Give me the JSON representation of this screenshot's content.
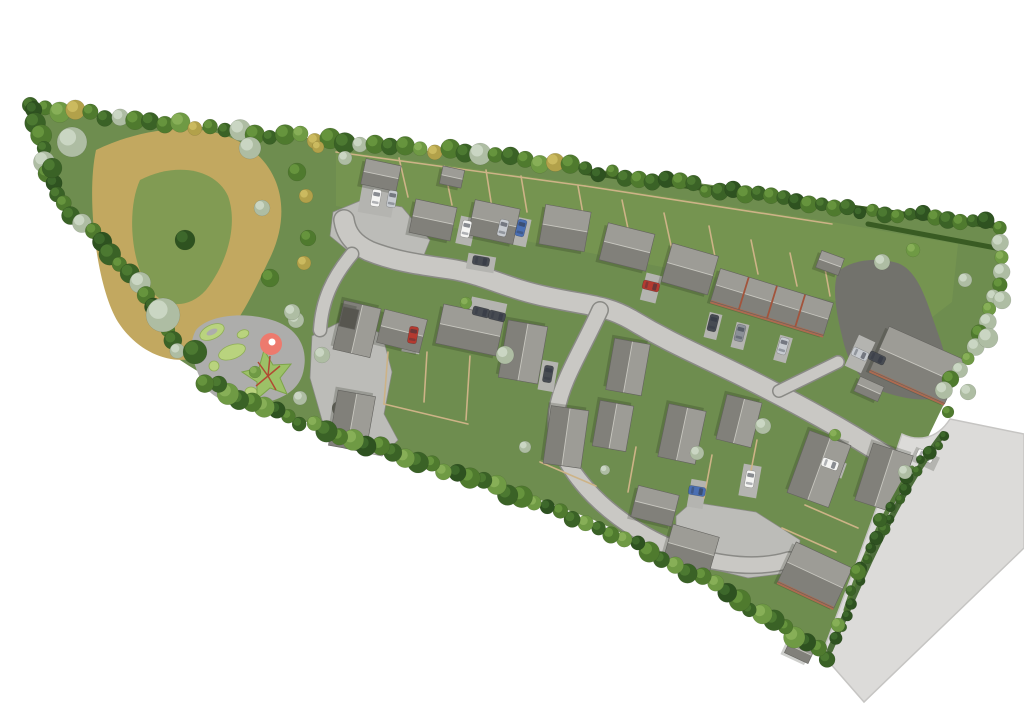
{
  "meta": {
    "description": "Aerial 3D rendered masterplan of a housing development with public open space, wildflower meadow, play area, tree-lined boundaries and an adjoining existing road",
    "canvas": {
      "w": 1024,
      "h": 723
    },
    "background": "#ffffff"
  },
  "palette": {
    "grass": "#6e8d4f",
    "garden_overlay": "#7c9c51",
    "meadow_tan": "#c2a860",
    "meadow_green": "#7d9a52",
    "paving": "#bcbcb8",
    "road_fill": "#c9c8c4",
    "road_casing": "#8a8a86",
    "existing_road": "#dcdbd9",
    "existing_road_edge": "#c6c5c3",
    "tarmac": "#72726c",
    "roof_light": "#9d9c96",
    "roof_dark": "#81807a",
    "roof_flat": "#57564f",
    "roof_outline": "#63625e",
    "ridge": "#c8c7c0",
    "brick": "#ad6a50",
    "party_wall": "#a2543c",
    "fence": "#cdb387",
    "hedge_dark": "#33551e",
    "hedge_mid": "#3c6128",
    "play_surface": "#adadab",
    "play_green": "#b9d37e",
    "play_green_edge": "#8fae56",
    "play_star": "#9cc167",
    "play_star_edge": "#7da449",
    "play_red": "#ed7a6e",
    "play_rope": "#b14a33",
    "shadow": "rgba(30,36,24,0.22)"
  },
  "car_colors": [
    "#f5f5f3",
    "#c7cbd0",
    "#8b9097",
    "#474b52",
    "#b43a30",
    "#4a6fb3"
  ],
  "tree_palettes": [
    [
      "#3a6226",
      "#4f7c33"
    ],
    [
      "#4f7a2e",
      "#68973f"
    ],
    [
      "#6f9a44",
      "#8ab15a"
    ],
    [
      "#aebda3",
      "#cdd8c6"
    ],
    [
      "#b2a14a",
      "#cdbd62"
    ],
    [
      "#2e5220",
      "#3f6a2c"
    ]
  ],
  "scene": {
    "site_grass": "M32 108 C150 122 350 142 585 168 C740 188 870 208 998 224 C1006 262 996 316 962 368 C930 430 880 540 826 655 C760 608 680 560 594 520 C500 484 400 450 300 420 C248 400 210 380 180 360 C148 318 118 268 80 224 C54 192 38 158 32 108 Z",
    "garden_overlay": "M336 150 L585 184 L832 222 L958 244 L952 302 L918 328 L832 300 L585 252 L336 206 Z",
    "meadow_outer": "M96 150 C150 124 215 120 252 150 C285 176 290 220 268 262 C252 296 236 330 210 352 C180 370 140 356 118 322 C96 286 86 196 96 150 Z",
    "meadow_inner": "M140 180 C175 162 215 168 228 196 C238 224 228 262 206 290 C186 312 158 308 144 280 C130 252 128 206 140 180 Z",
    "existing_road": "M950 419 L1024 434 L1024 548 L864 702 L822 654 C848 586 874 518 902 434 C916 441 936 441 950 419 Z",
    "courts": [
      "M333 212 L362 200 L402 207 L430 240 L422 260 L352 254 L330 236 Z",
      "M312 336 L348 318 L382 334 L392 372 L384 414 L398 440 L382 456 L344 448 L322 420 L310 378 Z",
      "M692 502 L756 512 L800 540 L796 572 L748 578 L700 566 L676 540 L676 516 Z"
    ],
    "roads": [
      {
        "d": "M898 464 C846 430 798 404 746 378 C700 355 672 344 632 320 C606 305 590 306 548 297 C508 289 483 274 450 269 C423 265 396 262 369 251 C354 244 346 234 344 220",
        "w": 19
      },
      {
        "d": "M600 310 C582 350 562 380 557 410 C553 440 564 463 587 489 C616 521 656 545 700 558 C731 566 762 568 789 560",
        "w": 15
      },
      {
        "d": "M779 391 L838 362",
        "w": 11
      },
      {
        "d": "M352 254 C332 278 322 300 320 330",
        "w": 12
      }
    ],
    "tarmac_court": "M838 272 C850 260 878 256 900 264 C916 272 924 292 934 322 C944 350 952 372 946 392 C938 402 912 402 884 392 C860 382 848 364 842 336 C836 312 832 288 838 272 Z",
    "driveways": [
      [
        487,
        313,
        36,
        26,
        12
      ],
      [
        413,
        337,
        18,
        32,
        10
      ],
      [
        548,
        376,
        16,
        30,
        10
      ],
      [
        651,
        288,
        16,
        28,
        14
      ],
      [
        466,
        231,
        16,
        28,
        12
      ],
      [
        512,
        230,
        34,
        28,
        12
      ],
      [
        377,
        200,
        34,
        30,
        10
      ],
      [
        713,
        326,
        13,
        26,
        14
      ],
      [
        740,
        336,
        13,
        26,
        14
      ],
      [
        783,
        349,
        13,
        26,
        16
      ],
      [
        697,
        494,
        16,
        28,
        10
      ],
      [
        750,
        481,
        18,
        32,
        10
      ],
      [
        830,
        466,
        16,
        30,
        110
      ],
      [
        925,
        459,
        15,
        26,
        115
      ],
      [
        481,
        263,
        16,
        28,
        100
      ],
      [
        860,
        354,
        34,
        18,
        115
      ]
    ],
    "planting_oval": {
      "cx": 347,
      "cy": 412,
      "rx": 16,
      "ry": 10,
      "rot": 25,
      "fill": "#5a5a52"
    },
    "houses": [
      [
        381,
        175,
        36,
        26,
        12,
        ""
      ],
      [
        452,
        177,
        22,
        18,
        12,
        ""
      ],
      [
        433,
        220,
        42,
        34,
        12,
        ""
      ],
      [
        494,
        222,
        46,
        36,
        12,
        ""
      ],
      [
        565,
        228,
        46,
        40,
        10,
        ""
      ],
      [
        627,
        247,
        48,
        38,
        14,
        ""
      ],
      [
        690,
        269,
        48,
        40,
        16,
        ""
      ],
      [
        772,
        302,
        118,
        34,
        17,
        "bt"
      ],
      [
        917,
        365,
        82,
        48,
        24,
        "b"
      ],
      [
        869,
        389,
        26,
        16,
        24,
        ""
      ],
      [
        830,
        263,
        24,
        18,
        20,
        ""
      ],
      [
        357,
        329,
        50,
        38,
        103,
        ""
      ],
      [
        349,
        318,
        20,
        16,
        103,
        "f"
      ],
      [
        352,
        421,
        56,
        38,
        100,
        ""
      ],
      [
        402,
        331,
        44,
        34,
        14,
        ""
      ],
      [
        470,
        330,
        62,
        40,
        12,
        ""
      ],
      [
        523,
        352,
        58,
        40,
        100,
        ""
      ],
      [
        628,
        367,
        52,
        36,
        100,
        ""
      ],
      [
        566,
        437,
        58,
        38,
        98,
        ""
      ],
      [
        613,
        426,
        46,
        34,
        100,
        ""
      ],
      [
        682,
        434,
        54,
        38,
        102,
        ""
      ],
      [
        739,
        421,
        46,
        36,
        104,
        ""
      ],
      [
        655,
        506,
        42,
        32,
        14,
        ""
      ],
      [
        691,
        549,
        48,
        38,
        16,
        ""
      ],
      [
        819,
        469,
        66,
        44,
        110,
        ""
      ],
      [
        884,
        478,
        60,
        42,
        108,
        ""
      ],
      [
        815,
        575,
        62,
        44,
        25,
        "b"
      ],
      [
        800,
        650,
        26,
        18,
        25,
        ""
      ]
    ],
    "cars": [
      [
        376,
        198,
        10,
        0
      ],
      [
        392,
        199,
        10,
        1
      ],
      [
        466,
        229,
        12,
        0
      ],
      [
        503,
        228,
        14,
        1
      ],
      [
        521,
        228,
        14,
        5
      ],
      [
        481,
        261,
        100,
        3
      ],
      [
        651,
        286,
        104,
        4
      ],
      [
        413,
        335,
        10,
        4
      ],
      [
        481,
        312,
        104,
        3
      ],
      [
        497,
        316,
        104,
        3
      ],
      [
        548,
        374,
        10,
        3
      ],
      [
        713,
        323,
        14,
        3
      ],
      [
        740,
        333,
        14,
        2
      ],
      [
        783,
        346,
        16,
        1
      ],
      [
        860,
        354,
        115,
        1
      ],
      [
        877,
        358,
        115,
        3
      ],
      [
        830,
        464,
        110,
        0
      ],
      [
        697,
        491,
        100,
        5
      ],
      [
        750,
        479,
        10,
        0
      ],
      [
        925,
        456,
        115,
        0
      ]
    ],
    "fences": [
      [
        408,
        197,
        399,
        158
      ],
      [
        452,
        205,
        444,
        166
      ],
      [
        492,
        208,
        486,
        170
      ],
      [
        527,
        212,
        521,
        176
      ],
      [
        585,
        225,
        578,
        186
      ],
      [
        630,
        238,
        622,
        200
      ],
      [
        672,
        250,
        664,
        213
      ],
      [
        716,
        262,
        709,
        226
      ],
      [
        758,
        274,
        751,
        240
      ],
      [
        797,
        286,
        790,
        253
      ],
      [
        830,
        296,
        824,
        263
      ],
      [
        336,
        152,
        585,
        186
      ],
      [
        585,
        186,
        832,
        224
      ],
      [
        388,
        352,
        384,
        404
      ],
      [
        427,
        352,
        424,
        402
      ],
      [
        470,
        356,
        466,
        420
      ],
      [
        384,
        404,
        468,
        424
      ],
      [
        540,
        462,
        596,
        486
      ],
      [
        636,
        447,
        628,
        492
      ],
      [
        712,
        455,
        704,
        498
      ],
      [
        757,
        440,
        748,
        486
      ],
      [
        805,
        505,
        858,
        528
      ],
      [
        782,
        528,
        836,
        552
      ]
    ],
    "hedges": [
      {
        "d": "M585 172 C720 190 860 210 998 226",
        "w": 6,
        "c": "#33551e"
      },
      {
        "d": "M868 224 L996 248",
        "w": 5,
        "c": "#33551e"
      },
      {
        "d": "M943 434 C908 480 878 540 852 600 L830 650",
        "w": 6,
        "c": "#3c6128"
      },
      {
        "d": "M912 468 C880 520 858 570 846 610",
        "w": 5,
        "c": "#4a732f"
      }
    ],
    "tree_belts": [
      {
        "pts": [
          [
            30,
            107
          ],
          [
            150,
            122
          ],
          [
            300,
            137
          ],
          [
            450,
            152
          ],
          [
            585,
            168
          ]
        ],
        "sp": 15,
        "r": [
          7,
          11
        ],
        "pal": [
          0,
          1,
          2,
          4,
          1,
          0,
          3,
          1
        ],
        "seed": 11
      },
      {
        "pts": [
          [
            585,
            170
          ],
          [
            720,
            190
          ],
          [
            860,
            210
          ],
          [
            998,
            224
          ]
        ],
        "sp": 13,
        "r": [
          6,
          9
        ],
        "pal": [
          0,
          5,
          1,
          0,
          1
        ],
        "seed": 22
      },
      {
        "pts": [
          [
            998,
            228
          ],
          [
            1002,
            272
          ],
          [
            988,
            322
          ],
          [
            960,
            370
          ],
          [
            938,
            402
          ]
        ],
        "sp": 13,
        "r": [
          6,
          9
        ],
        "pal": [
          1,
          3,
          2,
          3
        ],
        "seed": 33
      },
      {
        "pts": [
          [
            828,
            658
          ],
          [
            740,
            600
          ],
          [
            650,
            550
          ],
          [
            560,
            512
          ],
          [
            470,
            478
          ],
          [
            380,
            448
          ],
          [
            300,
            422
          ],
          [
            240,
            398
          ],
          [
            195,
            375
          ]
        ],
        "sp": 14,
        "r": [
          7,
          11
        ],
        "pal": [
          0,
          1,
          5,
          2,
          1,
          0,
          2
        ],
        "seed": 44
      },
      {
        "pts": [
          [
            32,
            110
          ],
          [
            44,
            162
          ],
          [
            62,
            205
          ],
          [
            92,
            232
          ],
          [
            122,
            262
          ],
          [
            148,
            294
          ],
          [
            168,
            330
          ],
          [
            180,
            362
          ]
        ],
        "sp": 13,
        "r": [
          7,
          12
        ],
        "pal": [
          5,
          0,
          1,
          0,
          3,
          1
        ],
        "seed": 55
      },
      {
        "pts": [
          [
            943,
            435
          ],
          [
            908,
            478
          ],
          [
            882,
            528
          ],
          [
            858,
            580
          ],
          [
            832,
            650
          ]
        ],
        "sp": 12,
        "r": [
          4,
          7
        ],
        "pal": [
          5,
          0,
          5
        ],
        "seed": 66
      }
    ],
    "trees": [
      [
        72,
        142,
        15,
        3
      ],
      [
        52,
        168,
        10,
        0
      ],
      [
        163,
        315,
        17,
        3
      ],
      [
        195,
        352,
        12,
        0
      ],
      [
        185,
        240,
        10,
        5
      ],
      [
        250,
        148,
        11,
        3
      ],
      [
        297,
        172,
        9,
        1
      ],
      [
        262,
        208,
        8,
        3
      ],
      [
        308,
        238,
        8,
        1
      ],
      [
        270,
        278,
        9,
        1
      ],
      [
        296,
        320,
        8,
        3
      ],
      [
        306,
        196,
        7,
        4
      ],
      [
        304,
        263,
        7,
        4
      ],
      [
        345,
        158,
        7,
        3
      ],
      [
        318,
        147,
        6,
        4
      ],
      [
        292,
        312,
        8,
        3
      ],
      [
        322,
        355,
        8,
        3
      ],
      [
        300,
        398,
        7,
        3
      ],
      [
        255,
        372,
        6,
        2
      ],
      [
        505,
        355,
        9,
        3
      ],
      [
        466,
        303,
        6,
        2
      ],
      [
        525,
        447,
        6,
        3
      ],
      [
        605,
        470,
        5,
        3
      ],
      [
        697,
        453,
        7,
        3
      ],
      [
        763,
        426,
        8,
        3
      ],
      [
        835,
        435,
        6,
        2
      ],
      [
        882,
        262,
        8,
        3
      ],
      [
        988,
        338,
        10,
        3
      ],
      [
        1002,
        300,
        9,
        3
      ],
      [
        968,
        392,
        8,
        3
      ],
      [
        948,
        412,
        6,
        1
      ],
      [
        905,
        472,
        7,
        3
      ],
      [
        858,
        572,
        8,
        1
      ],
      [
        880,
        520,
        7,
        0
      ],
      [
        838,
        625,
        7,
        2
      ],
      [
        913,
        250,
        7,
        2
      ],
      [
        965,
        280,
        7,
        3
      ]
    ],
    "playground": {
      "surface": "M196 330 C210 314 246 312 272 320 C296 327 308 346 304 368 C301 390 282 400 258 404 C232 408 208 398 200 378 C192 360 188 344 196 330 Z",
      "mounds": [
        {
          "cx": 212,
          "cy": 332,
          "rx": 13,
          "ry": 7,
          "rot": -25,
          "hole": true
        },
        {
          "cx": 232,
          "cy": 352,
          "rx": 14,
          "ry": 7,
          "rot": -20,
          "hole": false
        },
        {
          "cx": 214,
          "cy": 366,
          "rx": 5,
          "ry": 5,
          "rot": 0,
          "hole": false
        },
        {
          "cx": 243,
          "cy": 334,
          "rx": 6,
          "ry": 4,
          "rot": -20,
          "hole": false
        },
        {
          "cx": 251,
          "cy": 392,
          "rx": 6,
          "ry": 5,
          "rot": 0,
          "hole": false
        }
      ],
      "star": "264 350 273 365 291 364 280 378 287 394 270 388 257 399 257 382 242 372 259 368",
      "rope_lines": [
        [
          268,
          376,
          258,
          362
        ],
        [
          268,
          376,
          280,
          366
        ],
        [
          268,
          376,
          276,
          390
        ],
        [
          268,
          376,
          256,
          386
        ],
        [
          268,
          376,
          270,
          356
        ]
      ],
      "red_circle": {
        "cx": 271,
        "cy": 344,
        "r": 11
      },
      "white_dot": {
        "cx": 272,
        "cy": 342,
        "r": 3.5
      }
    }
  }
}
